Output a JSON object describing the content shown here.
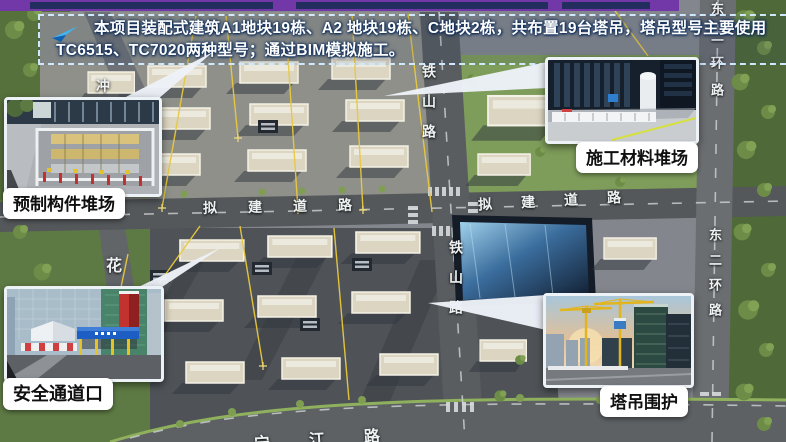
{
  "banner": {
    "text": "本项目装配式建筑A1地块19栋、A2 地块19栋、C地块2栋，共布置19台塔吊，塔吊型号主要使用TC6515、TC7020两种型号；通过BIM模拟施工。",
    "arrow_icon": "blue-pointer-arrow",
    "border_color": "#cfe8fb"
  },
  "slide_header": {
    "color": "#7238a8"
  },
  "callouts": [
    {
      "id": "prefab-component-yard",
      "label": "预制构件堆场",
      "photo": "prefab-component-yard-photo"
    },
    {
      "id": "construction-material-yard",
      "label": "施工材料堆场",
      "photo": "construction-material-yard-photo"
    },
    {
      "id": "safety-passage-entrance",
      "label": "安全通道口",
      "photo": "safety-passage-photo"
    },
    {
      "id": "tower-crane-enclosure",
      "label": "塔吊围护",
      "photo": "tower-crane-enclosure-photo"
    }
  ],
  "road_labels": {
    "tieshan_road_north": "铁山路",
    "tieshan_road_south": "铁山路",
    "proposed_road_west": "拟建道路",
    "proposed_road_east": "拟建道路",
    "east_second_ring_north": "东二环路",
    "east_second_ring_south": "东二环路",
    "hua_road_partial": "花",
    "chong_road_partial": "冲",
    "riverside_road_partial": "宁江路"
  },
  "colors": {
    "crane_line_yellow": "#e9c93e",
    "label_background": "#ffffff",
    "label_text": "#101010",
    "banner_text": "#ffffff"
  }
}
